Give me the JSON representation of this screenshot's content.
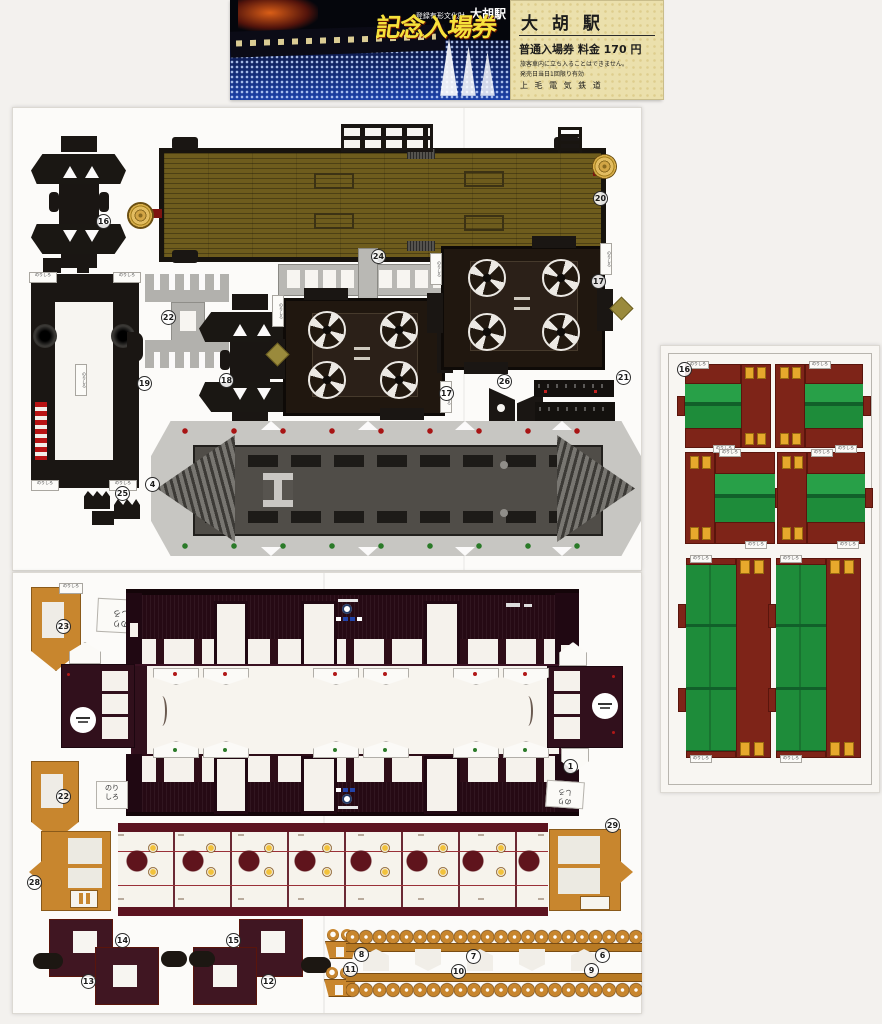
{
  "ticket": {
    "photo": {
      "heritage_caption": "登録有形文化財",
      "station": "大胡駅",
      "title": "記念入場券"
    },
    "stub": {
      "station": "大 胡 駅",
      "fare_line": "普通入場券 料金 170 円",
      "note1": "旅客車内に立ち入ることはできません。",
      "note2": "発売日当日1回限り有効",
      "company": "上 毛 電 気 鉄 道"
    }
  },
  "labels": {
    "glue_tab": "のりしろ",
    "glue_line1": "のり",
    "glue_line2": "しろ"
  },
  "part_numbers": {
    "bogie_frame_a": "16",
    "roof_floor": "20",
    "underframe": "19",
    "coupler_comb": "22",
    "bogie_frame_b": "18",
    "window_strip": "24",
    "wheel_box_a": "17",
    "wheel_box_b": "17",
    "detail_strips": "21",
    "corner_wedges": "26",
    "small_fittings": "25",
    "platform_roof": "4",
    "orange_strip_top": "23",
    "orange_strip_bottom": "22",
    "end_wall_right": "1",
    "orange_door_left": "28",
    "orange_door_right": "29",
    "l_piece_1": "14",
    "l_piece_2": "13",
    "l_piece_3": "15",
    "l_piece_4": "12",
    "couplers": "11",
    "knob_a": "8",
    "knob_b": "7",
    "knob_c": "6",
    "knob_d": "10",
    "knob_e": "9",
    "seat_sheet": "16"
  },
  "colors": {
    "car_maroon": "#3a1020",
    "seat_green": "#1e8c3a",
    "seat_red": "#7e2418",
    "part_orange": "#c8862e",
    "roof_olive": "#6e5c1d",
    "ticket_title_yellow": "#f6e23c"
  }
}
